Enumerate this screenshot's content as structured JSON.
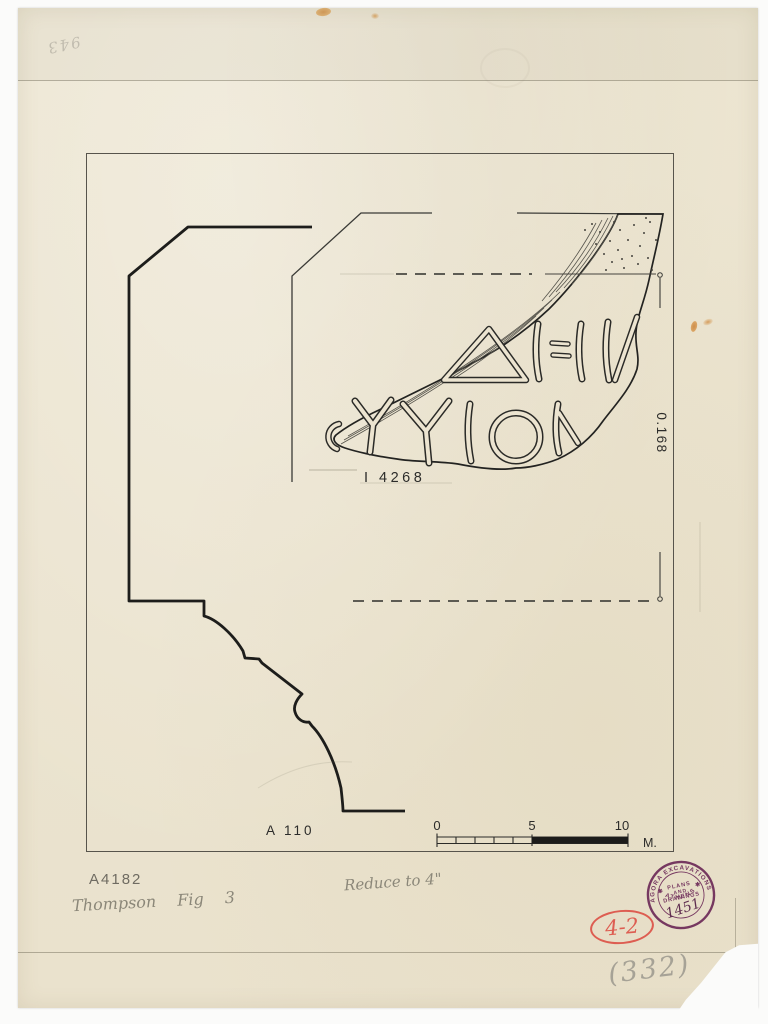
{
  "drawing": {
    "fragment_label": "I 4268",
    "profile_label": "A 110",
    "dimension_label": "0.168",
    "inscription_line1": "ΔΙ:ΙΝ",
    "inscription_line2": "ΟΥΥΙΟΝ",
    "scale_bar": {
      "zero": "0",
      "five": "5",
      "ten": "10",
      "unit": "M."
    }
  },
  "stamp": {
    "arc_top": "AGORA EXCAVATIONS",
    "arc_bottom": "✱ ATHENS ✱",
    "center_line1": "PLANS",
    "center_line2": "AND",
    "center_line3": "DRAWINGS",
    "number": "1451",
    "ink_color": "#6d2a58"
  },
  "annotations": {
    "catalog_number": "A4182",
    "author_figure_note": "Thompson Fig 3",
    "reduction_note": "Reduce to 4\"",
    "grading_number": "4-2",
    "page_number": "(332)",
    "corner_scribble": "943",
    "red_color": "#dd5348",
    "pencil_color": "#8b8779"
  }
}
